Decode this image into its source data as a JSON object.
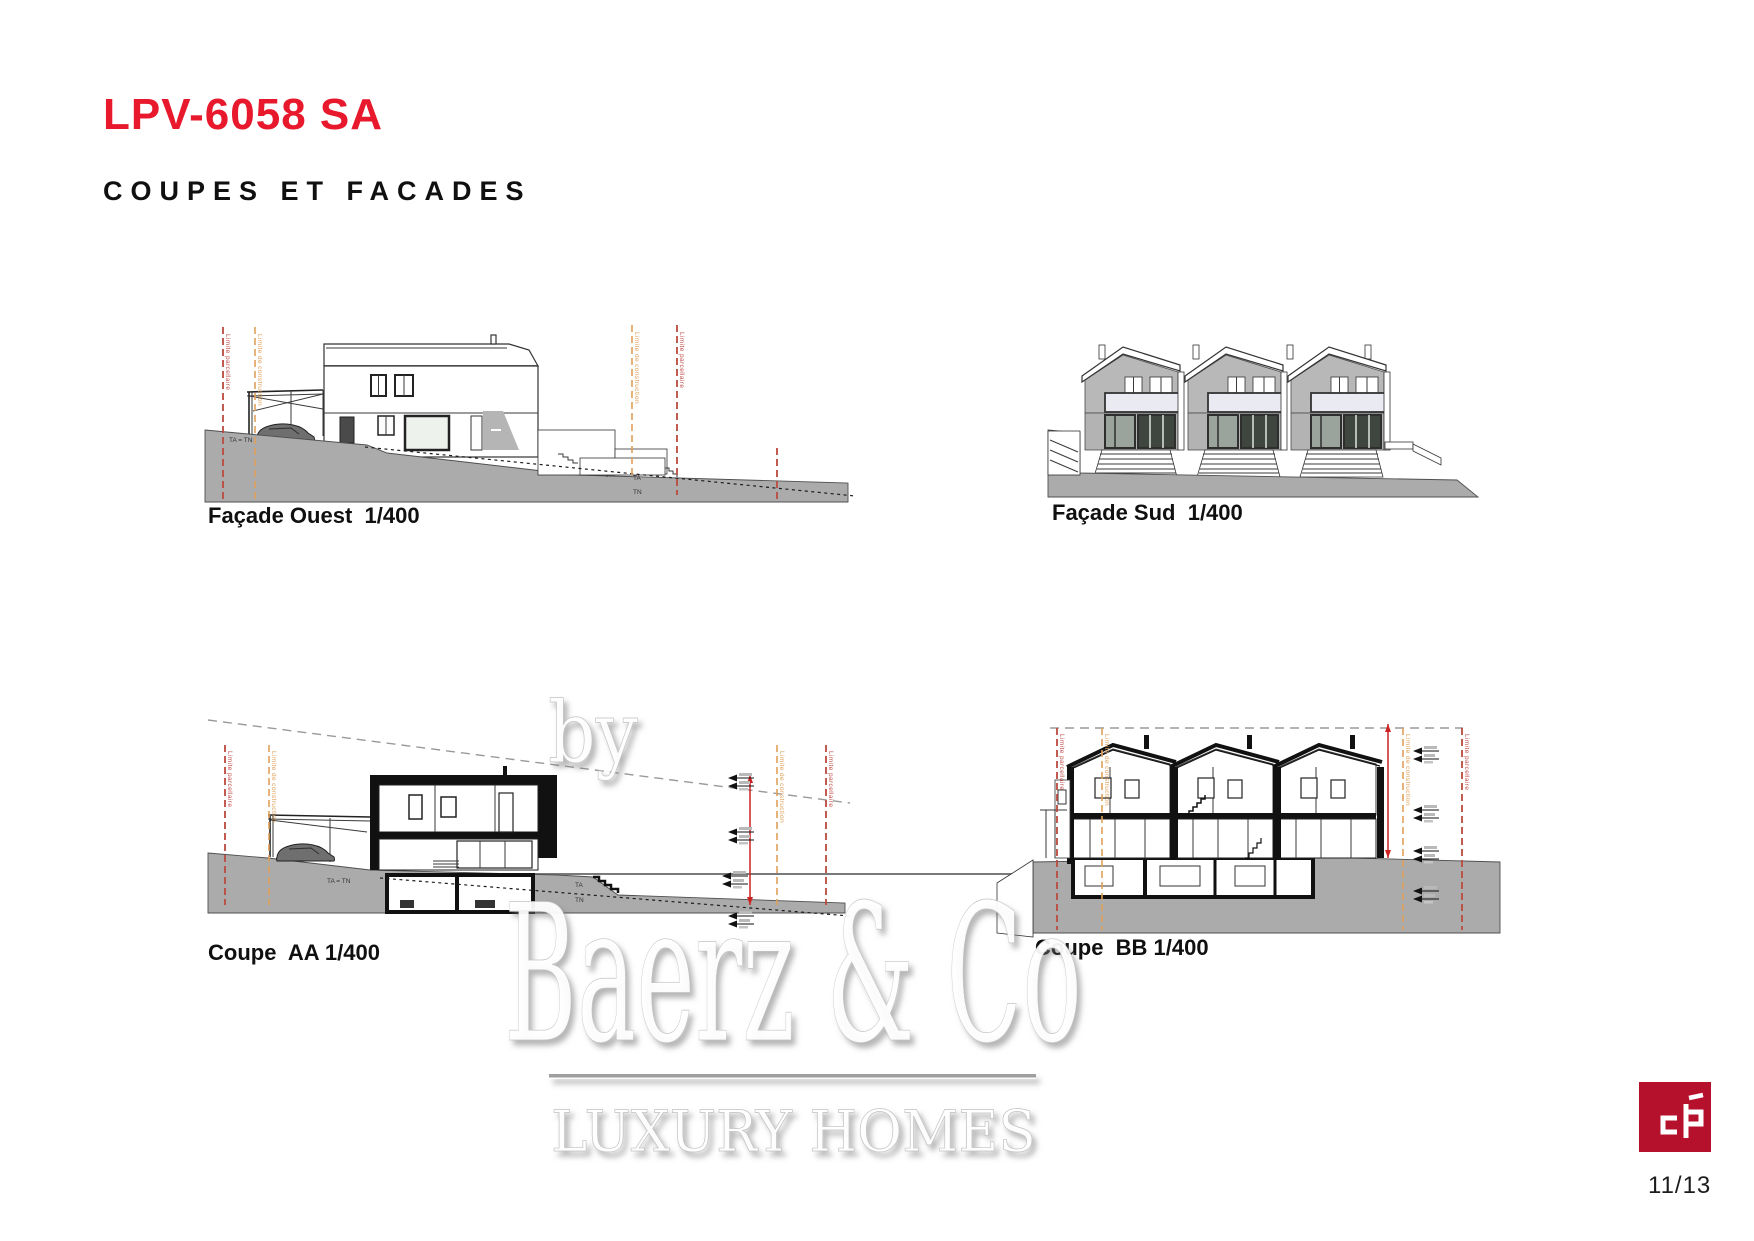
{
  "page": {
    "title": "LPV-6058 SA",
    "subtitle": "COUPES ET FACADES",
    "page_number": "11/13"
  },
  "drawings": {
    "facade_ouest": {
      "label": "Façade Ouest  1/400"
    },
    "facade_sud": {
      "label": "Façade Sud  1/400"
    },
    "coupe_aa": {
      "label": "Coupe  AA 1/400"
    },
    "coupe_bb": {
      "label": "Coupe  BB 1/400"
    }
  },
  "annotations": {
    "limite_parcellaire": "Limite parcellaire",
    "limite_construction": "Limite de construction",
    "ta_tn": "TA = TN",
    "ta": "TA",
    "tn": "TN"
  },
  "watermark": {
    "by": "by",
    "brand": "Baerz & Co",
    "tagline": "LUXURY HOMES"
  },
  "logo": {
    "monogram": "cp-monogram"
  },
  "colors": {
    "accent_red": "#e8192c",
    "boundary_red": "#bb4a3e",
    "boundary_orange": "#dfa05a",
    "terrain_gray": "#ababab",
    "logo_red": "#b5112c",
    "dash_gray": "#9a9a9a"
  }
}
